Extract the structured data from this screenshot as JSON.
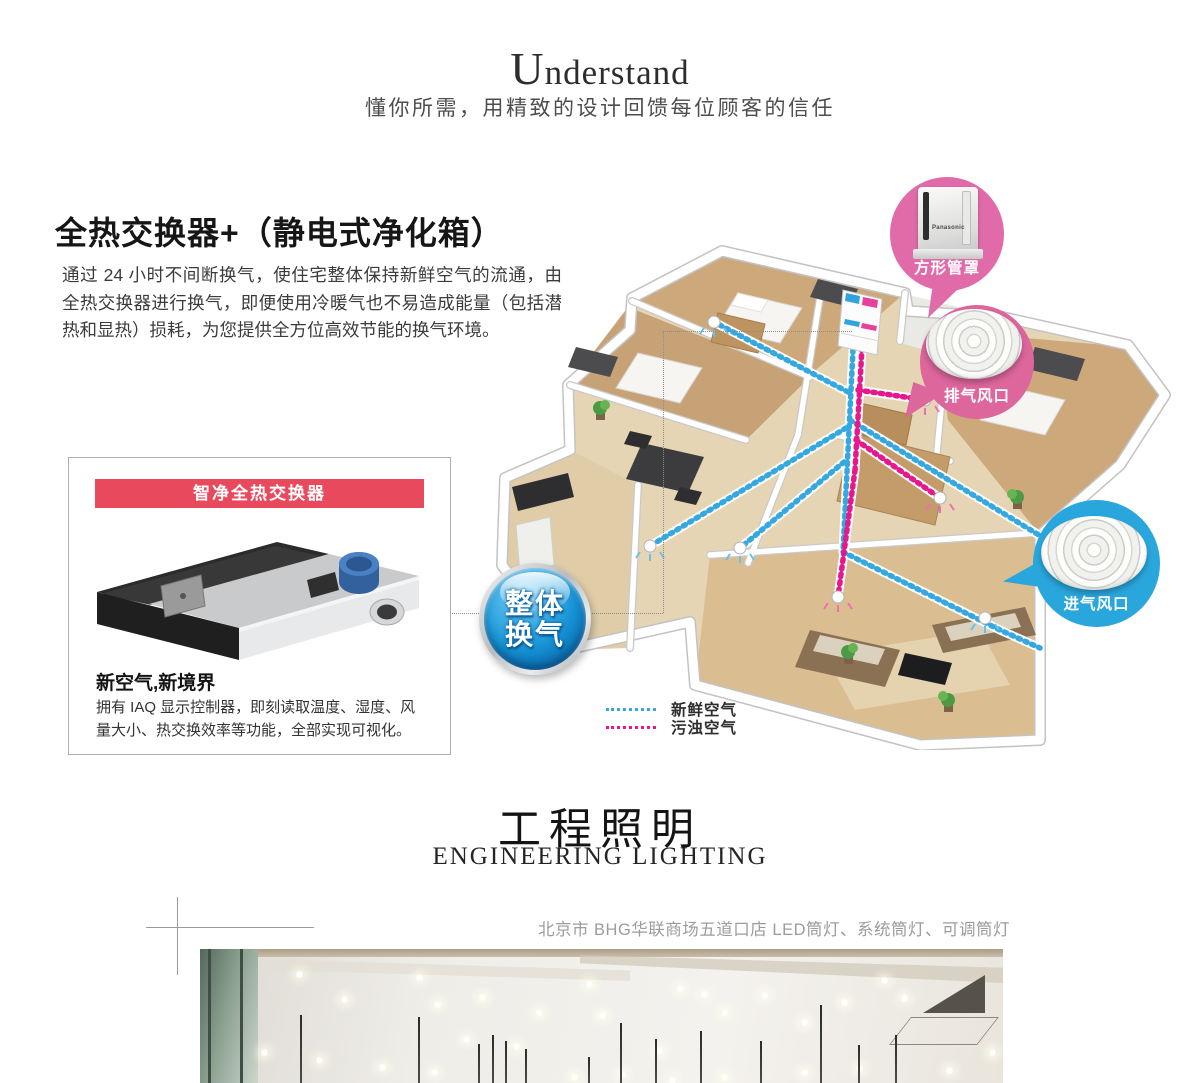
{
  "header": {
    "title": "Understand",
    "subtitle": "懂你所需，用精致的设计回馈每位顾客的信任"
  },
  "vent": {
    "heading": "全热交换器+（静电式净化箱）",
    "body": "通过 24 小时不间断换气，使住宅整体保持新鲜空气的流通，由全热交换器进行换气，即便使用冷暖气也不易造成能量（包括潜热和显热）损耗，为您提供全方位高效节能的换气环境。",
    "box": {
      "banner": "智净全热交换器",
      "title": "新空气,新境界",
      "desc": "拥有 IAQ 显示控制器，即刻读取温度、湿度、风量大小、热交换效率等功能，全部实现可视化。"
    },
    "badge": {
      "line1": "整体",
      "line2": "换气"
    },
    "callouts": {
      "square": "方形管罩",
      "exhaust": "排气风口",
      "intake": "进气风口",
      "brand": "Panasonic"
    },
    "legend": {
      "fresh": "新鲜空气",
      "dirty": "污浊空气"
    },
    "colors": {
      "banner_red": "#e8495c",
      "callout_pink": "#e06ba8",
      "callout_blue": "#29a7dd",
      "fresh_air_blue": "#35a8e0",
      "dirty_air_pink": "#e5188c"
    }
  },
  "lighting": {
    "heading_cn": "工程照明",
    "heading_en": "ENGINEERING LIGHTING",
    "caption": "北京市 BHG华联商场五道口店 LED筒灯、系统筒灯、可调筒灯"
  }
}
